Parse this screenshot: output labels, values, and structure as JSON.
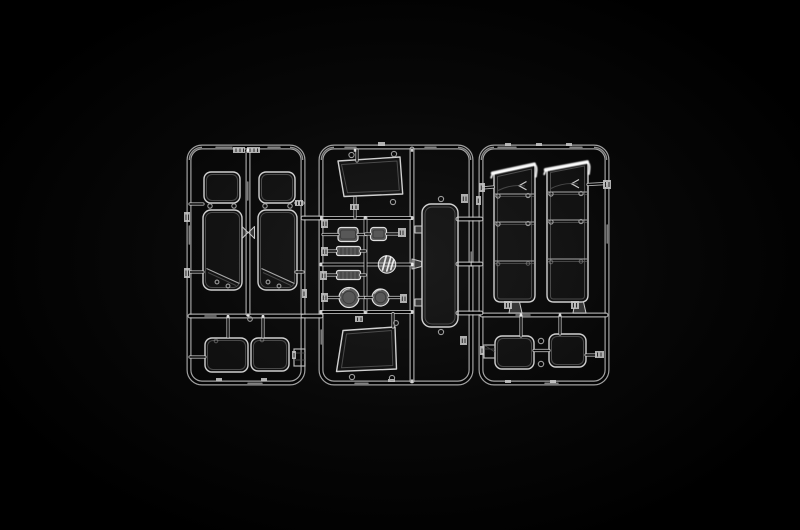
{
  "image": {
    "type": "studio product photograph",
    "subject": "Clear transparent plastic model kit sprue with window glazing and lens parts on a black background",
    "description": "Three interconnected rectangular runner frames molded in clear plastic holding transparent parts: quarter and door window panes, a tall rounded glazing panel, two slanted door glasses, segmented sleeper-cab side window strips, rear window pairs, rectangular headlight lenses, ribbed indicator lens bars, round lamp lenses and a small clear disc. Edge-lit clear plastic on solid black.",
    "background": "#000000"
  },
  "palette": {
    "background": "#000000",
    "runner_edge": "#c9c9c9",
    "part_outline": "#d0d0d0",
    "inner_contour": "#6f6f6f",
    "specular_highlight": "#ffffff",
    "molded_tab": "#c6c6c6",
    "glass_fill": "rgba(255,255,255,0.04)"
  },
  "frames": [
    {
      "name": "left runner frame",
      "contents": [
        "quarter window pane × 2",
        "tall door window pane × 2 with diagonal mold line",
        "rear window pair",
        "small bracket",
        "molded part-number tabs"
      ]
    },
    {
      "name": "middle runner frame",
      "contents": [
        "slanted door glass (top)",
        "rectangular headlight lens × 2",
        "ribbed indicator lens bar × 2",
        "round lamp lens × 2",
        "small clear disc",
        "tall rounded glazing panel",
        "slanted door glass (bottom)"
      ]
    },
    {
      "name": "right runner frame",
      "contents": [
        "segmented side window strip × 2 with bright top edge",
        "rear window pair",
        "small bracket"
      ]
    }
  ]
}
